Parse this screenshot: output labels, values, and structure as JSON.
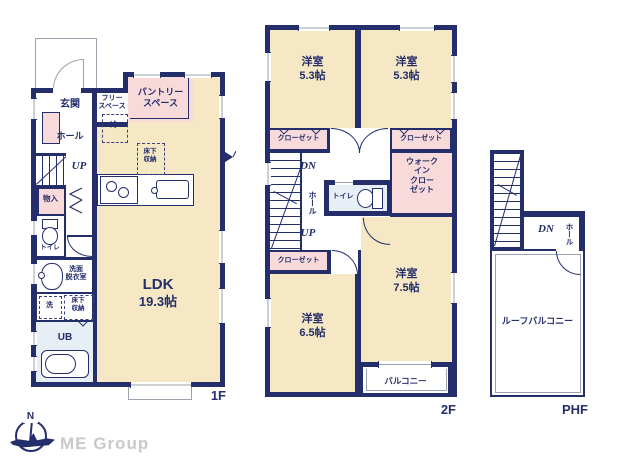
{
  "document_type": "floor-plan",
  "colors": {
    "wall_navy": "#232e6b",
    "room_cream": "#f7e8c5",
    "closet_pink": "#f9dada",
    "wet_area_blue": "#e7eef5",
    "outline_gray": "#9aa3ad",
    "logo_gray": "#c9c9c9"
  },
  "floor1": {
    "label": "1F",
    "entrance": "玄関",
    "free_space": "フリー\nスペース",
    "pantry": "パントリー\nスペース",
    "hall": "ホール",
    "stairs_up": "UP",
    "storage": "物入",
    "toilet": "トイレ",
    "washroom": "洗面\n脱衣室",
    "laundry": "洗",
    "underfloor_storage": "床下\n収納",
    "fridge": "冷",
    "unit_bath": "UB",
    "ldk_name": "LDK",
    "ldk_size": "19.3帖"
  },
  "floor2": {
    "label": "2F",
    "bedroom": "洋室",
    "bedroom1_size": "5.3帖",
    "bedroom2_size": "5.3帖",
    "bedroom3_size": "7.5帖",
    "bedroom4_size": "6.5帖",
    "closet": "クローゼット",
    "walk_in_closet": "ウォーク\nイン\nクロー\nゼット",
    "toilet": "トイレ",
    "hall": "ホール",
    "stairs_dn": "DN",
    "stairs_up": "UP",
    "balcony": "バルコニー"
  },
  "floor_phf": {
    "label": "PHF",
    "stairs_dn": "DN",
    "hall": "ホール",
    "roof_balcony": "ルーフバルコニー"
  },
  "logo": {
    "company": "ME Group",
    "compass_north": "N"
  }
}
